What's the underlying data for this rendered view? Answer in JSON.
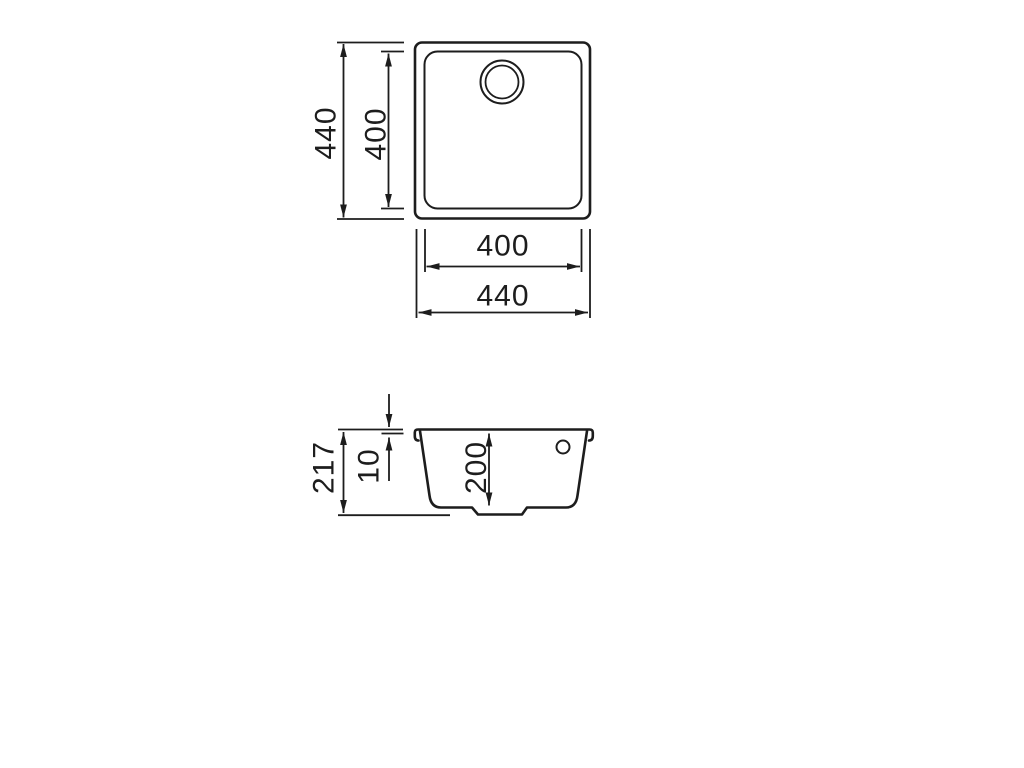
{
  "page": {
    "background_color": "#ffffff"
  },
  "drawing": {
    "kind": "technical-dimension-drawing",
    "subject": "square undermount sink, top view and cross-section view",
    "line_color": "#1d1d1d",
    "top_view": {
      "labels": {
        "overall_height": "440",
        "inner_height": "400",
        "inner_width": "400",
        "overall_width": "440"
      }
    },
    "section_view": {
      "labels": {
        "total_depth": "217",
        "rim_thickness": "10",
        "bowl_depth": "200"
      }
    }
  }
}
